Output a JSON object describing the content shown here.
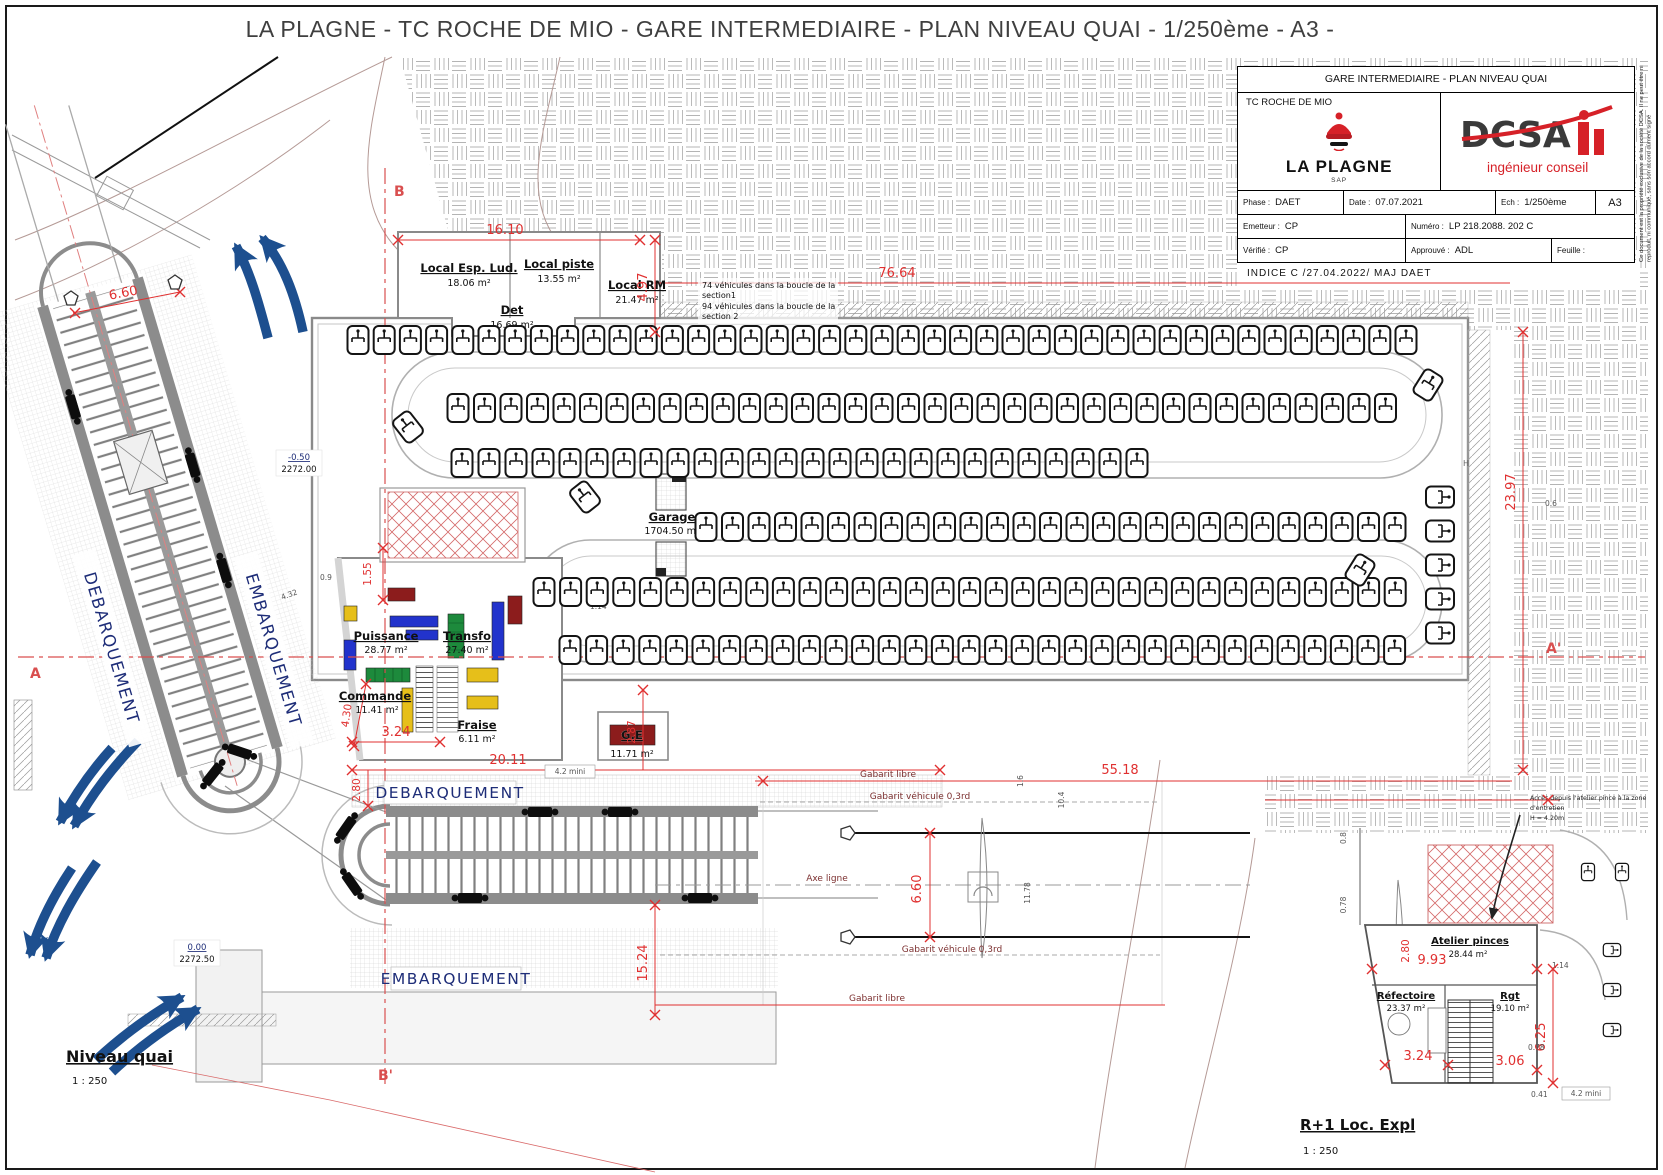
{
  "page": {
    "title": "LA PLAGNE - TC ROCHE DE MIO - GARE INTERMEDIAIRE - PLAN NIVEAU QUAI - 1/250ème - A3 -"
  },
  "title_block": {
    "doc_title": "GARE INTERMEDIAIRE - PLAN NIVEAU QUAI",
    "project": "TC ROCHE DE MIO",
    "client_name": "LA PLAGNE",
    "client_sub": "SAP",
    "firm_name": "DCSA",
    "firm_tagline": "ingénieur conseil",
    "phase_label": "Phase :",
    "phase": "DAET",
    "date_label": "Date :",
    "date": "07.07.2021",
    "scale_label": "Ech :",
    "scale": "1/250ème",
    "format": "A3",
    "emitter_label": "Emetteur :",
    "emitter": "CP",
    "number_label": "Numéro :",
    "number": "LP 218.2088. 202  C",
    "verified_label": "Vérifié :",
    "verified": "CP",
    "approved_label": "Approuvé :",
    "approved": "ADL",
    "sheet_label": "Feuille :",
    "indice": "INDICE C   /27.04.2022/   MAJ DAET",
    "side_note": "Ce document est la propriété exclusive de la société DCSA. Il ne peut être ni reproduit, ni communiqué, sans son accord dûment signé"
  },
  "rooms": {
    "esp_lud": {
      "name": "Local Esp. Lud.",
      "area": "18.06 m²"
    },
    "piste": {
      "name": "Local piste",
      "area": "13.55 m²"
    },
    "rm": {
      "name": "Local RM",
      "area": "21.47 m²"
    },
    "det": {
      "name": "Det",
      "area": "16.69 m²"
    },
    "garage": {
      "name": "Garage",
      "area": "1704.50 m²"
    },
    "puissance": {
      "name": "Puissance",
      "area": "28.77 m²"
    },
    "transfo": {
      "name": "Transfo",
      "area": "27.40 m²"
    },
    "commande": {
      "name": "Commande",
      "area": "11.41 m²"
    },
    "fraise": {
      "name": "Fraise",
      "area": "6.11 m²"
    },
    "ge": {
      "name": "G.E",
      "area": "11.71 m²"
    }
  },
  "inset": {
    "title": "R+1 Loc. Expl",
    "scale": "1 : 250",
    "atelier": {
      "name": "Atelier pinces",
      "area": "28.44 m²"
    },
    "refectoire": {
      "name": "Réfectoire",
      "area": "23.37 m²"
    },
    "rgt": {
      "name": "Rgt",
      "area": "19.10 m²"
    },
    "note_l1": "Accès depuis l'atelier pince à la zone",
    "note_l2": "d'entretien",
    "note_l3": "H = 4.20m",
    "dims": {
      "d280": "2.80",
      "d993": "9.93",
      "d324": "3.24",
      "d306": "3.06",
      "d625": "6.25",
      "d114": "1.14",
      "d078": "0.78",
      "d041": "0.41",
      "d42": "4.2 mini",
      "d08": "0.8"
    }
  },
  "labels": {
    "debarquement": "DEBARQUEMENT",
    "embarquement": "EMBARQUEMENT",
    "axe_ligne": "Axe ligne",
    "gabarit_libre": "Gabarit libre",
    "gabarit_vehicule": "Gabarit véhicule 0,3rd",
    "niveau_quai": "Niveau quai",
    "niveau_scale": "1 : 250"
  },
  "notes": {
    "vehicles_l1": "74 véhicules dans la boucle de la",
    "vehicles_l2": "section1",
    "vehicles_l3": "94 véhicules dans la boucle de la",
    "vehicles_l4": "section 2"
  },
  "sections": {
    "a": "A",
    "a_prime": "A'",
    "b": "B",
    "b_prime": "B'"
  },
  "elevations": {
    "upper_level": "-0.50",
    "upper_alt": "2272.00",
    "lower_level": "0.00",
    "lower_alt": "2272.50"
  },
  "dims": {
    "d1610": "16.10",
    "d497": "4.97",
    "d7664": "76.64",
    "d660tl": "6.60",
    "d2397": "23.97",
    "d2011": "20.11",
    "d280": "2.80",
    "d287": "2.87",
    "d155": "1.55",
    "d430": "4.30",
    "d324": "3.24",
    "d5518": "55.18",
    "d660": "6.60",
    "d1524": "15.24",
    "d114": "1.14",
    "d42min": "4.2 mini",
    "d104": "10.4",
    "d1178": "11.78",
    "d16": "1.6",
    "d06": "0.6",
    "d09": "0.9",
    "d432": "4.32"
  },
  "misc": {
    "h": "H"
  },
  "colors": {
    "dim_red": "#e03030",
    "label_blue": "#1e2d78",
    "arrow_blue": "#1d4f8f",
    "logo_red": "#d62128",
    "equip_blue": "#2233cc",
    "equip_green": "#1d8a3c",
    "equip_yellow": "#e6bf1a",
    "dark_red": "#8c1c1c"
  }
}
